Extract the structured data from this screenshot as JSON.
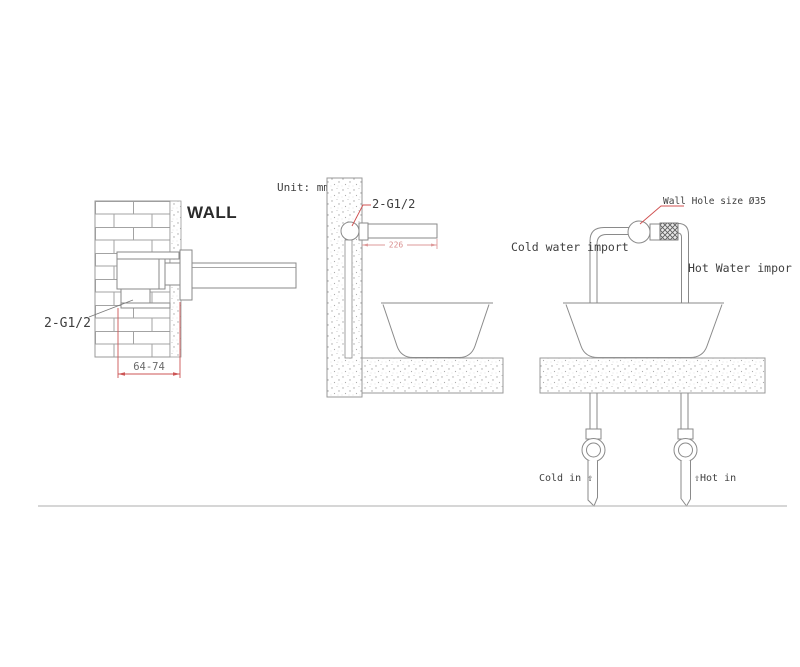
{
  "left_view": {
    "wall_label": "WALL",
    "thread_label": "2-G1/2",
    "depth_dimension": "64-74"
  },
  "middle_view": {
    "unit_label": "Unit: mm",
    "thread_label": "2-G1/2",
    "spout_dimension": "226"
  },
  "right_view": {
    "wall_hole_label": "Wall Hole size Ø35",
    "cold_import_label": "Cold water import",
    "hot_import_label": "Hot Water impor",
    "cold_in_label": "Cold in ⇧",
    "hot_in_label": "⇧Hot in"
  },
  "colors": {
    "line_gray": "#8a8a8a",
    "text_dark": "#3f3f3f",
    "dimension_red": "#cc5555",
    "dimension_pink": "#de9a9a",
    "leader_red": "#d05050",
    "ground_line": "#bdbdbd"
  }
}
